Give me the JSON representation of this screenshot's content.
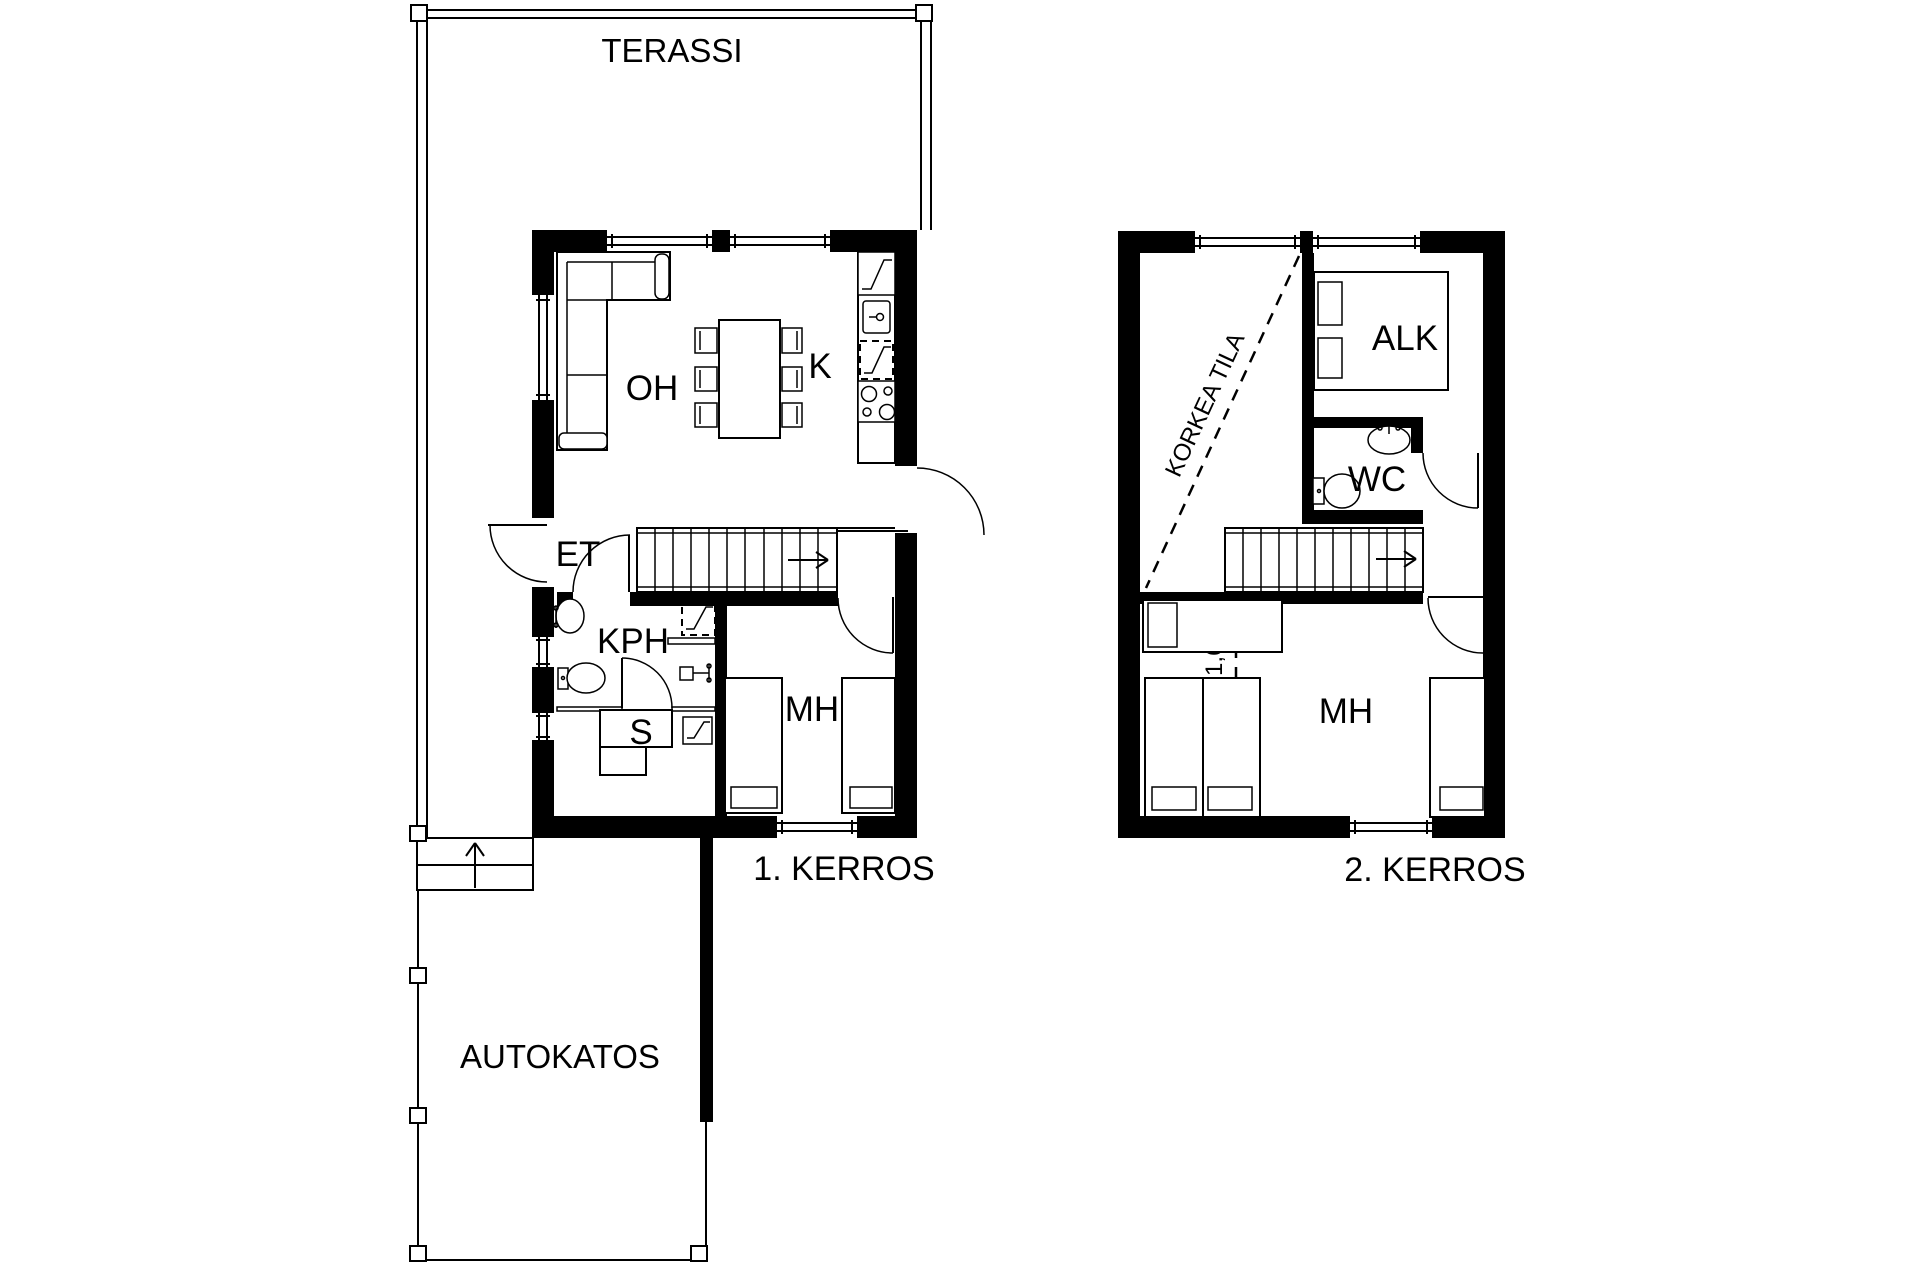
{
  "page": {
    "background": "#ffffff",
    "line_color": "#000000"
  },
  "floor1": {
    "title": "1. KERROS",
    "rooms": {
      "terassi": "TERASSI",
      "oh": "OH",
      "k": "K",
      "et": "ET",
      "kph": "KPH",
      "s": "S",
      "mh": "MH",
      "autokatos": "AUTOKATOS"
    }
  },
  "floor2": {
    "title": "2. KERROS",
    "rooms": {
      "alk": "ALK",
      "wc": "WC",
      "mh": "MH"
    },
    "annotations": {
      "korkea_tila": "KORKEA TILA",
      "korkeus": "KORKEUS 1,6 m"
    }
  }
}
